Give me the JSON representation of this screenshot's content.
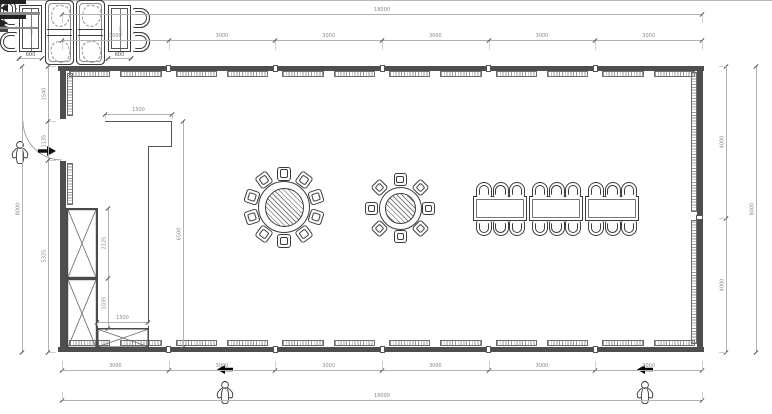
{
  "dimensions": {
    "top": {
      "total": "18000",
      "segments": [
        "3000",
        "3000",
        "3000",
        "3000",
        "3000",
        "3000"
      ]
    },
    "bottom": {
      "total": "18000",
      "segments": [
        "3000",
        "3000",
        "3000",
        "3000",
        "3000",
        "3000"
      ]
    },
    "left": {
      "total": "8000",
      "segments": [
        "1540",
        "1135",
        "5325"
      ]
    },
    "right": {
      "total": "8000",
      "segments": [
        "4000",
        "4000"
      ]
    },
    "interior": {
      "counter_width": "1500",
      "counter_length": "6500",
      "cabinet_upper": "2125",
      "cabinet_lower": "1035",
      "cabinet_base": "1500",
      "table_length": "1200",
      "table_width": "600"
    }
  },
  "furniture_summary": {
    "booth_groups_top": 3,
    "booth_groups_bottom": 2,
    "round_table_large_seats": 10,
    "round_table_small_seats": 8,
    "banquet_tables": 3,
    "banquet_seats": 18,
    "wall_cabinets": 2,
    "base_cabinets": 1,
    "entrances": 3,
    "scale_figures": 3
  },
  "colors": {
    "line": "#3c3c3c",
    "wall": "#4e4e4e",
    "dim": "#8a8a8a",
    "accent": "#000000"
  }
}
